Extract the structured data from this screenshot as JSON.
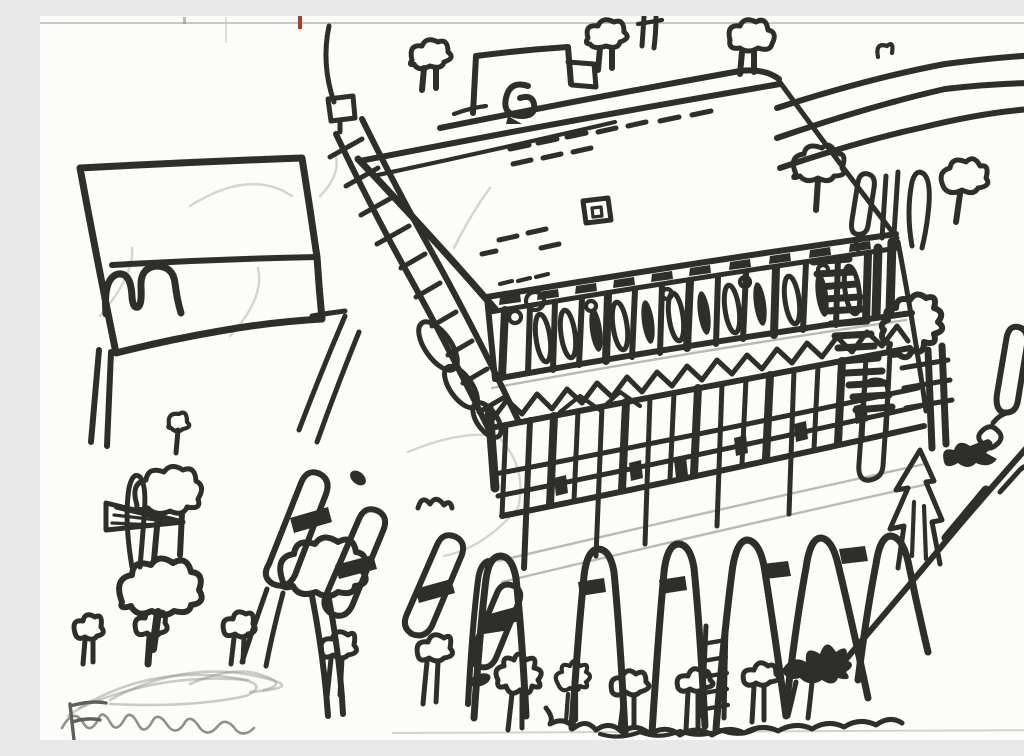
{
  "meta": {
    "title": "Scanned child's black marker drawing of a large tilted building with a colonnade, lattice fence, arched fence posts, roads, lollipop trees and an M signboard",
    "medium": "black marker and pencil on white paper"
  },
  "palette": {
    "paper": "#fcfcfb",
    "ink": "#2e2e2a",
    "pencil": "#a3a3a1",
    "scan_border": "#c7c7c5",
    "red_registration_tick": "#b8372b"
  },
  "signature": {
    "text": "Emiliano",
    "medium": "pencil",
    "position": "bottom-left, partially cut off"
  },
  "scene": {
    "elements": [
      {
        "name": "scan-border-artifacts",
        "label": "Scanner border lines and a small red registration tick along the top edge"
      },
      {
        "name": "pencil-underdrawing",
        "label": "Faint pencil guide lines, arcs and sketch marks under the ink"
      },
      {
        "name": "m-signboard",
        "label": "Rectangular roadside signboard with M-shaped arches, a divider line and two post legs"
      },
      {
        "name": "ladder-walkway",
        "label": "Diagonal ladder-like walkway with rungs, oval stepping links and a small square cap"
      },
      {
        "name": "building-roof",
        "label": "Large tilted roof plane with dormer box, dashed shingle marks and a small square window"
      },
      {
        "name": "colonnade",
        "label": "Upper facade band of columns with dark capitals, small circles and tall oval windows"
      },
      {
        "name": "hatched-corner",
        "label": "Densely hatched building corner with a blobby cloud shape and a capsule door"
      },
      {
        "name": "lattice-fence",
        "label": "Cross-hatched lattice band with a zigzag scribble row on top and dark patches"
      },
      {
        "name": "arcade-fence",
        "label": "Row of tall arched fence posts with dark collar bands and a small ladder post"
      },
      {
        "name": "bottom-plants",
        "label": "Flowers, sprouting mushroom bushes, wavy ground scribble and a dark leaf-bird shape"
      },
      {
        "name": "left-trees",
        "label": "Lollipop cloud-top trees, a narrow cypress and a hatched wedge shape"
      },
      {
        "name": "fan-posts",
        "label": "Fan of tilted capsule posts with dark cross bands and mushroom trees beneath"
      },
      {
        "name": "road-lines",
        "label": "Three long wavy parallel road lines running to the upper right corner"
      },
      {
        "name": "right-trees",
        "label": "Row of small trees and narrow shrubs below the road lines"
      },
      {
        "name": "top-trees",
        "label": "Small cloud-top trees and a curled sprout along the top edge"
      },
      {
        "name": "right-slope",
        "label": "Jagged fir shapes, dark winged blob, exclamation capsule and a long diagonal slope line"
      },
      {
        "name": "signature",
        "label": "Pencil signature scribble reading Emiliano, partially cut off at the bottom left"
      }
    ]
  }
}
